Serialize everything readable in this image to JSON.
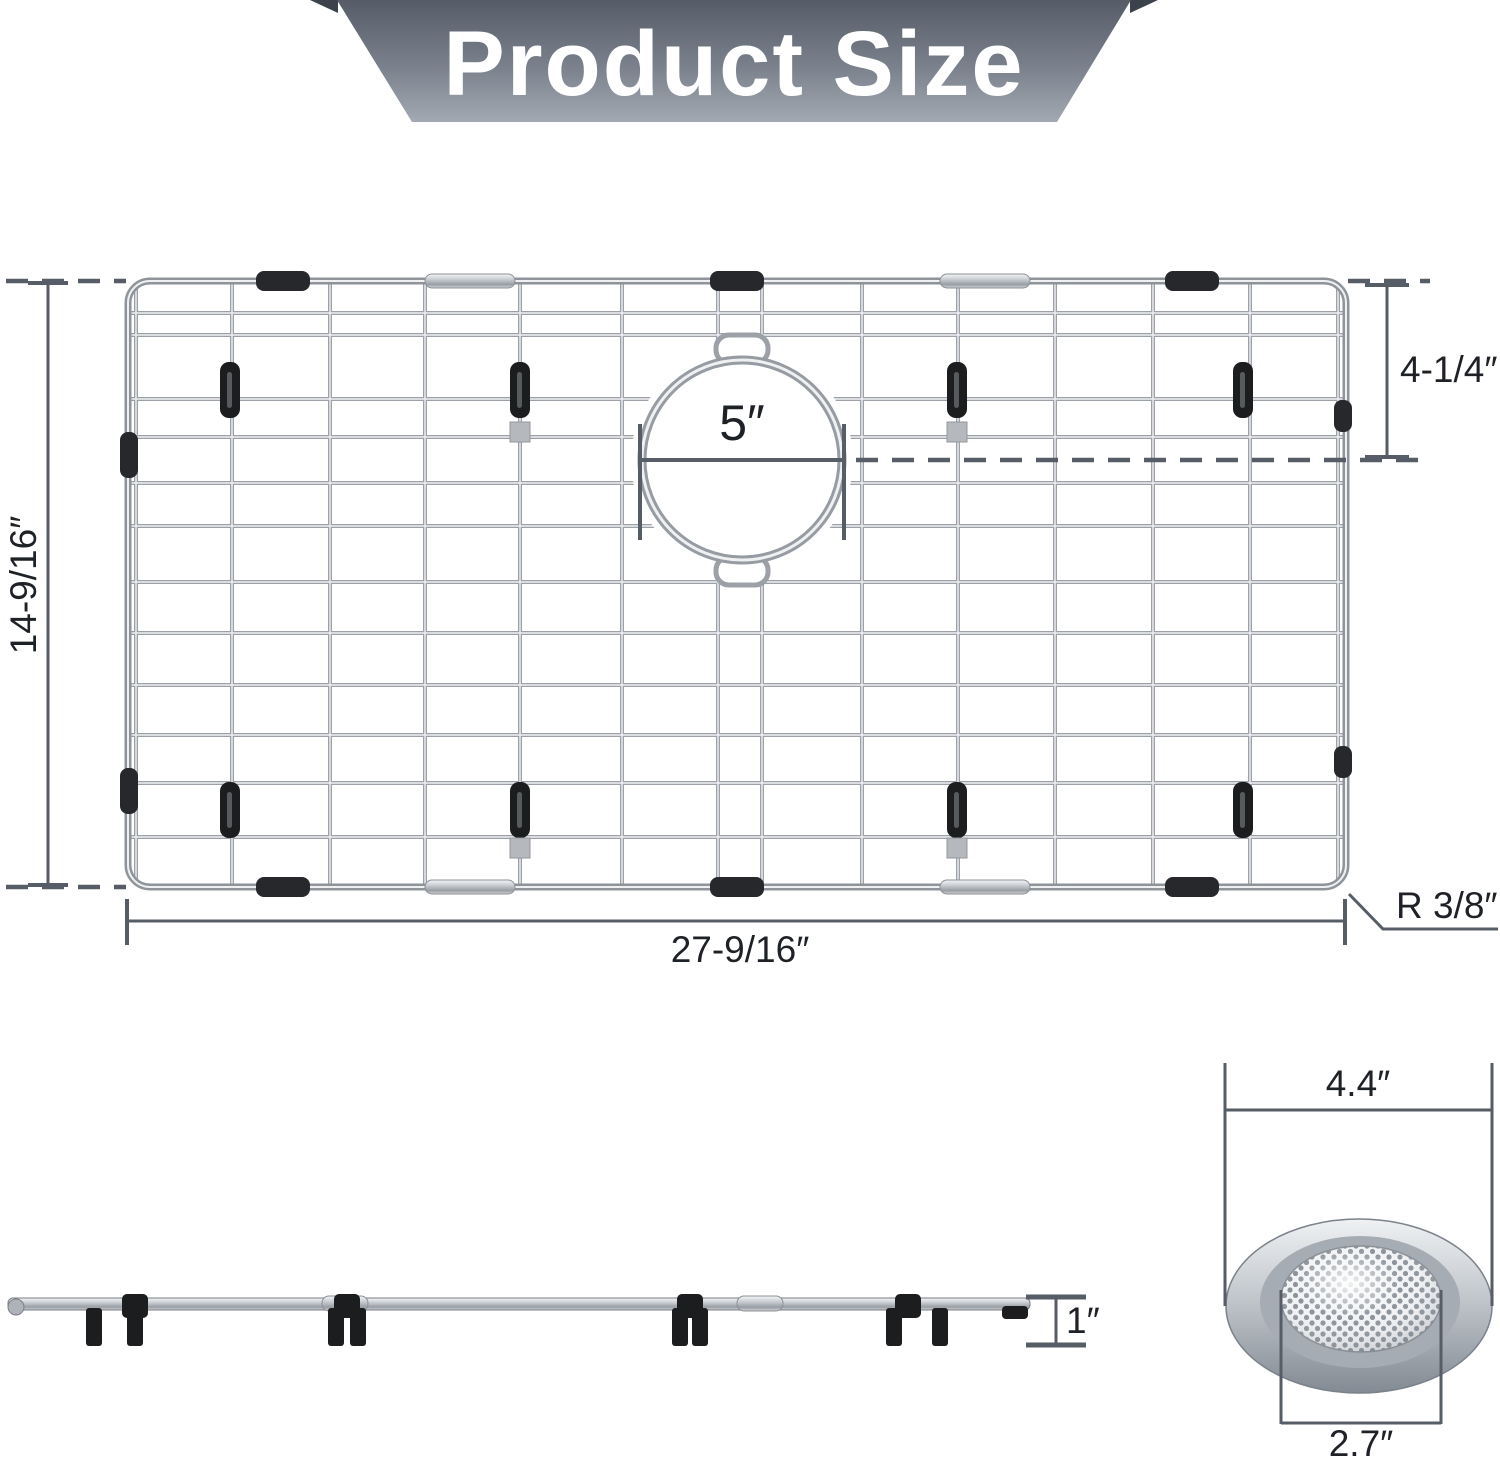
{
  "header": {
    "title": "Product Size"
  },
  "top_view": {
    "height_label": "14-9/16″",
    "width_label": "27-9/16″",
    "drain_offset_label": "4-1/4″",
    "drain_diameter_label": "5″",
    "corner_radius_label": "R 3/8″"
  },
  "side_view": {
    "height_label": "1″"
  },
  "strainer": {
    "outer_diameter_label": "4.4″",
    "inner_diameter_label": "2.7″"
  },
  "colors": {
    "dimension_line": "#565d67",
    "label_text": "#1e2126",
    "banner_top": "#59606b",
    "banner_bottom": "#9ca4ad",
    "wire": "#9ca1a7",
    "foot_black": "#1b1d1f"
  }
}
